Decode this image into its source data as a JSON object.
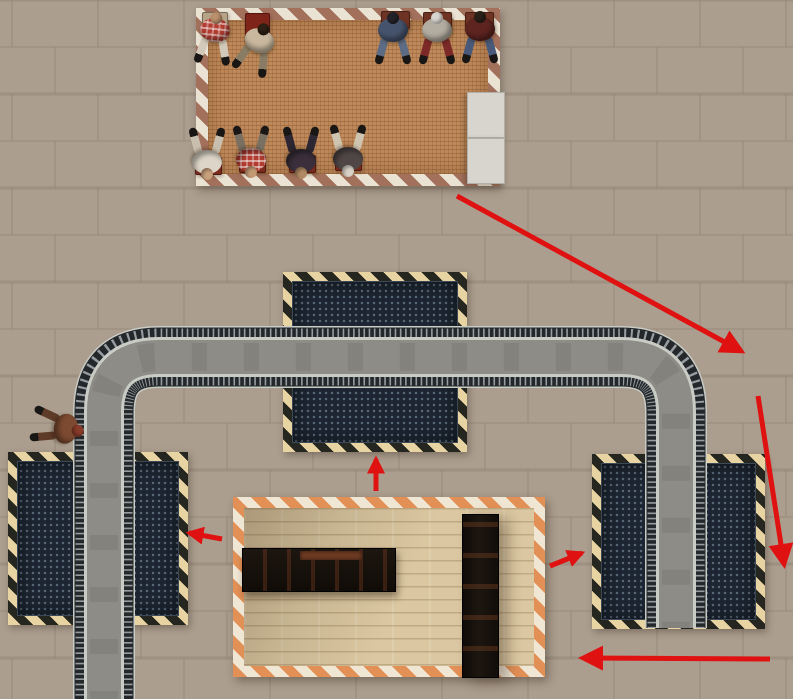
{
  "canvas": {
    "width": 793,
    "height": 699
  },
  "colors": {
    "ground": "#ac9e8e",
    "tile_line": "#8f8170",
    "mat": "#bf8a5b",
    "mat_stripe_light": "#eae2d2",
    "mat_stripe_dark": "#a3705b",
    "platform": "#1c2531",
    "platform_stripe_light": "#e8d4a3",
    "platform_stripe_dark": "#262620",
    "track_asphalt": "#8d8c87",
    "track_rail": "#24282b",
    "track_tick": "#969ca0",
    "track_edge": "#c9cbc5",
    "wood": "#dbc8a2",
    "stall_stripe_orange": "#e39056",
    "stall_stripe_light": "#f0e6d4",
    "counter": "#17110d",
    "counter_rust": "#6e3b22",
    "bench": "#d8d5cf",
    "arrow": "#e01111"
  },
  "waiting_area": {
    "rect": [
      196,
      8,
      304,
      178
    ],
    "benches": [
      [
        467,
        92,
        36,
        44
      ],
      [
        467,
        138,
        36,
        44
      ]
    ],
    "chairs": [
      {
        "rect": [
          202,
          12,
          24,
          14
        ],
        "color": "#b5a488"
      },
      {
        "rect": [
          245,
          13,
          23,
          25
        ],
        "color": "#7e2418"
      },
      {
        "rect": [
          381,
          11,
          27,
          16
        ],
        "color": "#6e3322"
      },
      {
        "rect": [
          423,
          12,
          27,
          16
        ],
        "color": "#6e3322"
      },
      {
        "rect": [
          465,
          12,
          27,
          16
        ],
        "color": "#6e3322"
      },
      {
        "rect": [
          195,
          157,
          25,
          16
        ],
        "color": "#7c2a1c"
      },
      {
        "rect": [
          239,
          155,
          25,
          16
        ],
        "color": "#7c2a1c"
      },
      {
        "rect": [
          289,
          155,
          25,
          16
        ],
        "color": "#7c2a1c"
      },
      {
        "rect": [
          335,
          153,
          25,
          16
        ],
        "color": "#7c2a1c"
      }
    ],
    "people": [
      {
        "x": 214,
        "y": 40,
        "rot": 6,
        "shirt": "#b23c30",
        "plaid": true,
        "pants": "#d3c9ba",
        "head": "#bb906c"
      },
      {
        "x": 256,
        "y": 50,
        "rot": 20,
        "shirt": "#c9b89e",
        "plaid": false,
        "pants": "#8a7c64",
        "head": "#2e2014"
      },
      {
        "x": 393,
        "y": 40,
        "rot": 0,
        "shirt": "#46536c",
        "plaid": false,
        "pants": "#5d6c85",
        "head": "#23232a"
      },
      {
        "x": 437,
        "y": 40,
        "rot": 0,
        "shirt": "#b3aca0",
        "plaid": false,
        "pants": "#7c2a28",
        "head": "#d9d5cf"
      },
      {
        "x": 480,
        "y": 39,
        "rot": 0,
        "shirt": "#5e2420",
        "plaid": false,
        "pants": "#49597a",
        "head": "#2a2018"
      },
      {
        "x": 207,
        "y": 152,
        "rot": 180,
        "shirt": "#ddd6c8",
        "plaid": false,
        "pants": "#c9bfae",
        "head": "#c9a27d"
      },
      {
        "x": 251,
        "y": 150,
        "rot": 180,
        "shirt": "#b23c30",
        "plaid": true,
        "pants": "#7a7062",
        "head": "#c59b76"
      },
      {
        "x": 301,
        "y": 151,
        "rot": 180,
        "shirt": "#3a2f3a",
        "plaid": false,
        "pants": "#2c2733",
        "head": "#b08a64"
      },
      {
        "x": 348,
        "y": 149,
        "rot": 180,
        "shirt": "#504646",
        "plaid": false,
        "pants": "#cfc4b0",
        "head": "#d8d2c8"
      }
    ]
  },
  "walker": {
    "x": 56,
    "y": 427,
    "rot": 100,
    "shirt": "#7c4a30",
    "plaid": false,
    "pants": "#5e3a28",
    "head": "#8a3c2a"
  },
  "platforms": {
    "center": {
      "outer": [
        283,
        272,
        184,
        180
      ]
    },
    "left": {
      "outer": [
        8,
        452,
        180,
        173
      ]
    },
    "right": {
      "outer": [
        592,
        454,
        173,
        175
      ]
    }
  },
  "track": {
    "path": "M 104 706 L 104 412 Q 104 357 159 357 L 621 357 Q 676 357 676 412 L 676 628"
  },
  "stall": {
    "outer": [
      233,
      497,
      312,
      180
    ],
    "counter": [
      242,
      548,
      152,
      42
    ],
    "counter_lip": [
      300,
      551,
      62,
      9
    ],
    "wall": [
      462,
      514,
      35,
      162
    ]
  },
  "arrows": [
    {
      "from": [
        457,
        196
      ],
      "to": [
        741,
        351
      ]
    },
    {
      "from": [
        758,
        396
      ],
      "to": [
        784,
        564
      ]
    },
    {
      "from": [
        770,
        659
      ],
      "to": [
        583,
        658
      ]
    },
    {
      "from": [
        222,
        539
      ],
      "to": [
        189,
        533
      ]
    },
    {
      "from": [
        376,
        491
      ],
      "to": [
        376,
        459
      ]
    },
    {
      "from": [
        550,
        566
      ],
      "to": [
        582,
        553
      ]
    }
  ]
}
